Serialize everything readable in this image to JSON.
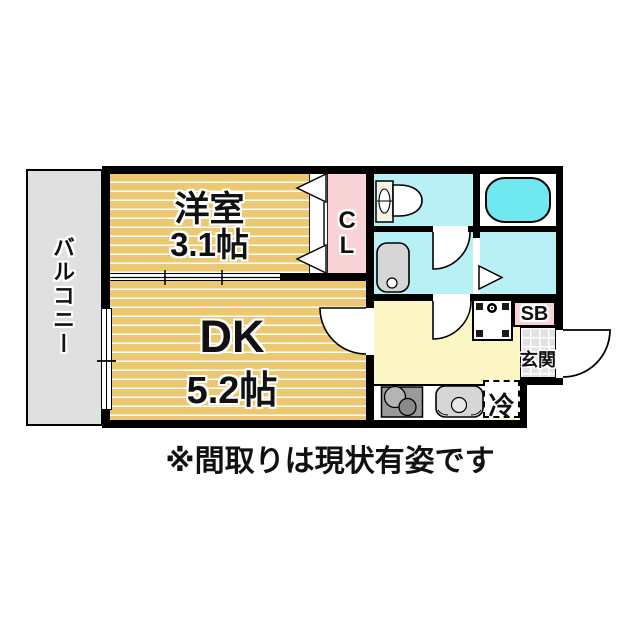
{
  "title": "floor-plan",
  "caption": "※間取りは現状有姿です",
  "labels": {
    "balcony": "バルコニー",
    "western_room_name": "洋室",
    "western_room_size": "3.1帖",
    "dk_name": "DK",
    "dk_size": "5.2帖",
    "closet": "CL",
    "shoe_box": "SB",
    "entrance": "玄関",
    "refrigerator": "冷"
  },
  "fixtures": [
    "toilet",
    "bathtub",
    "washbasin",
    "washing-machine-pan",
    "gas-stove",
    "kitchen-sink",
    "entrance-door-arc",
    "room-door-arcs",
    "bath-folding-door",
    "closet-bifold-door",
    "balcony-sliding-window",
    "room-sliding-door"
  ],
  "colors": {
    "wall": "#000000",
    "room-tan": "#ecc873",
    "room-stripe": "#ffffff",
    "kitchen-yellow": "#fbf6c3",
    "wet-cyan": "#b9f0f5",
    "tub-cyan": "#6fe9ef",
    "closet-pink": "#f8d3d6",
    "balcony-gray": "#e0e0e0",
    "tile-gray": "#e2e2e2",
    "fixture-gray": "#d6d6d6",
    "stove-gray": "#9a9a9a"
  }
}
